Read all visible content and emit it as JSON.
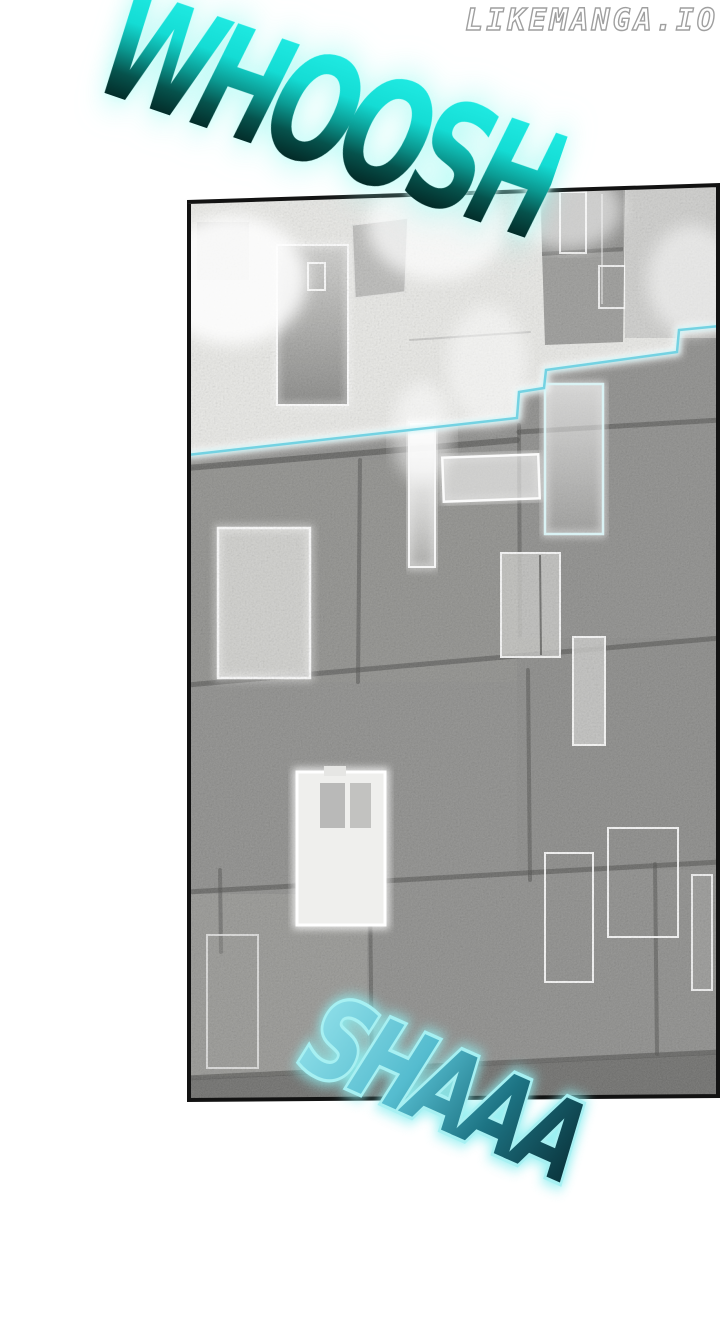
{
  "page": {
    "width": 720,
    "height": 1336,
    "background": "#ffffff"
  },
  "watermark": {
    "text": "LIKEMANGA.IO",
    "fill": "#ffffff",
    "outline": "#9f9f9f"
  },
  "sfx": {
    "whoosh": {
      "text": "WHOOSH",
      "color_top": "#1feae2",
      "color_bottom": "#021d1b",
      "glow": "#9ef8f0"
    },
    "shaaa": {
      "text": "SHAAA",
      "color_top": "#8fdfe9",
      "color_bottom": "#0a343c",
      "glow": "#8deef0"
    }
  },
  "panel": {
    "description": "tilted comic panel of a noisy stone-block wall; washed-out bright upper zone, gray lower zone, glowing white window rectangles, stepped cyan energy line",
    "border_color": "#121212",
    "wall_gray": "#8f8f8d",
    "bright_zone": "#e8e8e5",
    "mortar_color": "#4e4e4c",
    "energy_line_color": "#74d2e2",
    "glow_rect_color": "#ffffff"
  }
}
